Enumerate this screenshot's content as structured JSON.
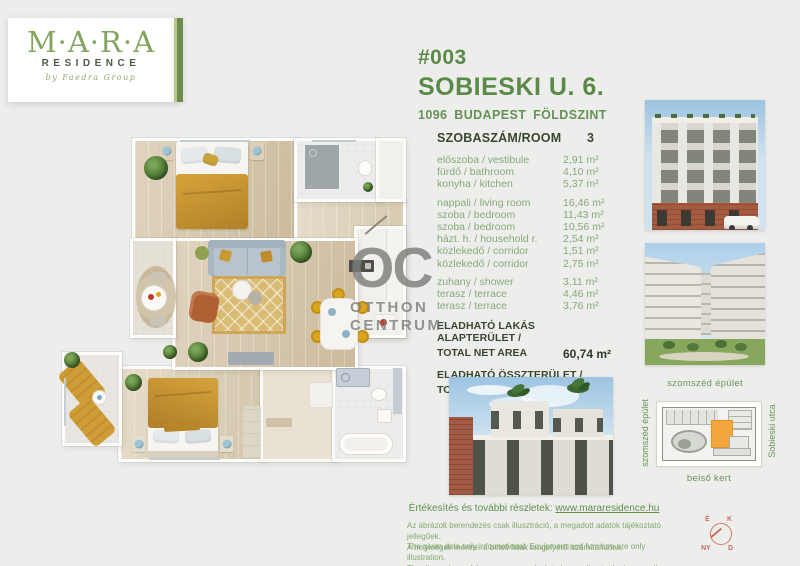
{
  "logo": {
    "name": "M·A·R·A",
    "sub": "RESIDENCE",
    "byline": "by Faedra Group"
  },
  "header": {
    "unit_number": "#003",
    "street": "SOBIESKI U. 6.",
    "city_line": "1096 BUDAPEST FÖLDSZINT"
  },
  "table": {
    "header_label": "SZOBASZÁM/ROOM",
    "header_value": "3",
    "rows": [
      {
        "label": "előszoba / vestibule",
        "value": "2,91 m²"
      },
      {
        "label": "fürdő / bathroom",
        "value": "4,10 m²"
      },
      {
        "label": "konyha / kitchen",
        "value": "5,37 m²"
      },
      {
        "label": "nappali / living room",
        "value": "16,46 m²"
      },
      {
        "label": "szoba / bedroom",
        "value": "11,43 m²"
      },
      {
        "label": "szoba / bedroom",
        "value": "10,56 m²"
      },
      {
        "label": "házt. h. / household r.",
        "value": "2,54 m²"
      },
      {
        "label": "közlekedő / corridor",
        "value": "1,51 m²"
      },
      {
        "label": "közlekedő / corridor",
        "value": "2,75 m²"
      },
      {
        "label": "zuhany / shower",
        "value": "3,11 m²"
      },
      {
        "label": "terasz / terrace",
        "value": "4,46 m²"
      },
      {
        "label": "terasz / terrace",
        "value": "3,76 m²"
      }
    ],
    "totals": [
      {
        "label_hu": "ELADHATÓ LAKÁS ALAPTERÜLET /",
        "label_en": "TOTAL  NET AREA",
        "value": "60,74 m²"
      },
      {
        "label_hu": "ELADHATÓ ÖSSZTERÜLET /",
        "label_en": "TOTAL AREA",
        "value": "64,85 m²"
      }
    ]
  },
  "watermark": {
    "abbr": "OC",
    "line1": "OTTHON",
    "line2": "CENTRUM"
  },
  "labels": {
    "neighbor_photo": "szomszéd épület",
    "siteplan_left": "szomszéd épület",
    "siteplan_right": "Sobieski utca",
    "siteplan_bottom": "belső kert"
  },
  "footer": {
    "sales_prefix": "Értékesítés és további részletek: ",
    "sales_link": "www.mararesidence.hu",
    "disclaimer_hu_1": "Az ábrázolt berendezés csak illusztráció, a megadott adatok tájékoztató jellegűek.",
    "disclaimer_hu_2": "A helyiségek méretei a belső falak tengelyétől számítandóak.",
    "disclaimer_en_1": "The given data only informational. Equipment and furniture are only illustration.",
    "disclaimer_en_2": "The dimensions of the rooms are calculated according to the inner wall- access."
  },
  "compass": {
    "n": "É",
    "e": "K",
    "w": "NY",
    "s": "D"
  },
  "colors": {
    "accent_green": "#5b8948",
    "light_green": "#86a978",
    "dark_text": "#39462f",
    "mustard": "#c5942f",
    "watermark_gray": "#7b7e7a",
    "highlight_orange": "#f4a63e",
    "compass_red": "#cb6f62",
    "page_bg": "#edeeec"
  }
}
